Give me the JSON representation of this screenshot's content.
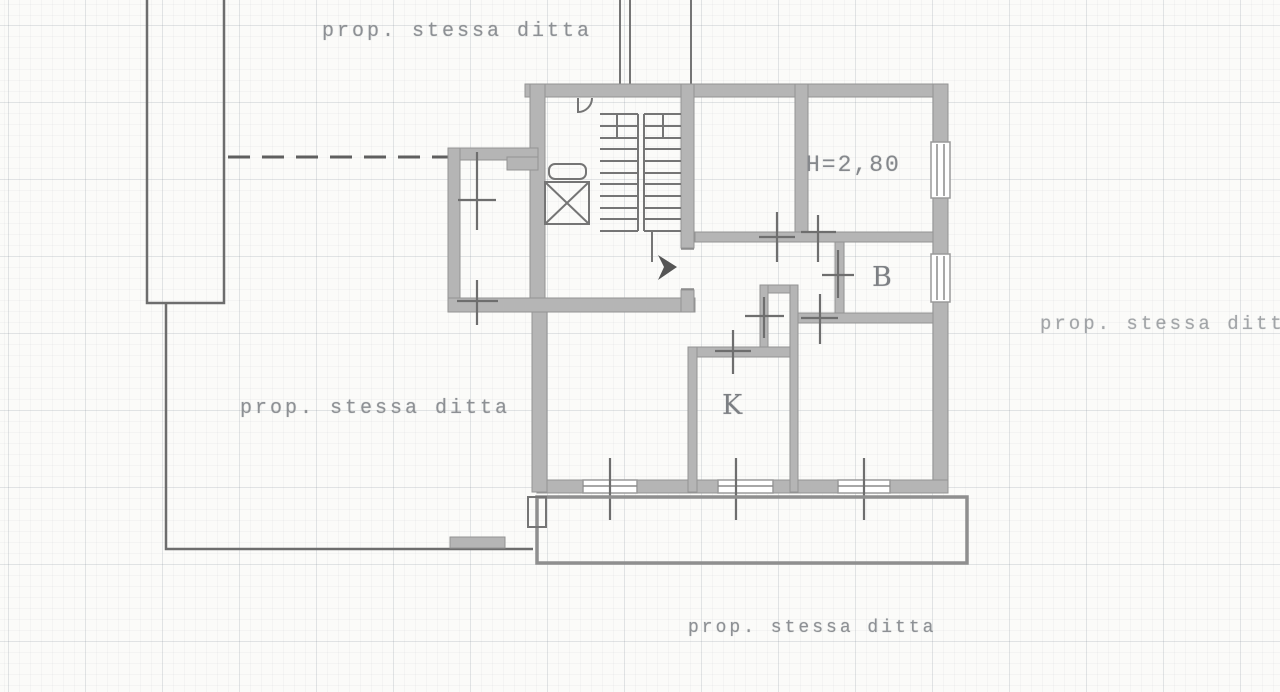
{
  "plan": {
    "kind": "cadastral apartment floor plan (scanned)",
    "labels": {
      "prop_top": "prop. stessa ditta",
      "prop_left": "prop. stessa ditta",
      "prop_right": "prop. stessa ditta",
      "prop_bottom": "prop. stessa ditta",
      "ceiling_height": "H=2,80",
      "room_b": "B",
      "room_k": "K"
    },
    "colors": {
      "paper": "#fbfbf9",
      "grid_line": "#7d8794",
      "wall_fill": "#b5b5b5",
      "wall_edge": "#939393",
      "thin_line": "#757575",
      "boundary_line": "#6d6d6d",
      "label_text": "#8d9094",
      "entrance_arrow": "#555555"
    }
  }
}
